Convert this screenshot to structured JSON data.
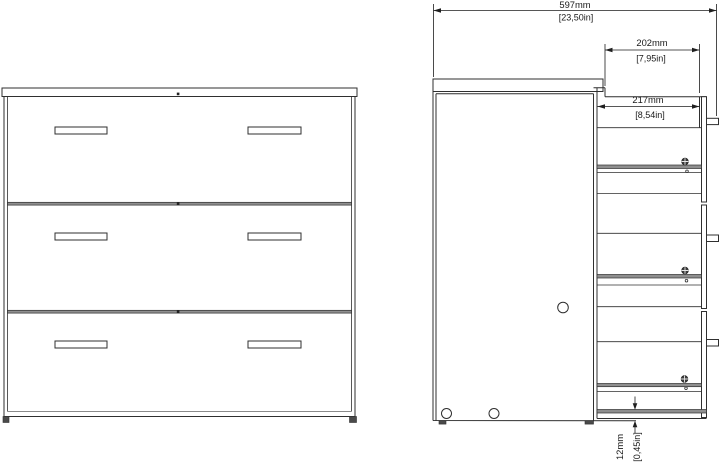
{
  "drawing": {
    "background": "#ffffff",
    "line_color": "#2f2f2f",
    "views": {
      "front_view_name": "front-view-3-drawer-chest",
      "side_view_name": "side-section-view"
    },
    "dimensions": {
      "overall_width": {
        "mm": "597mm",
        "in": "[23,50in]"
      },
      "top_section_depth": {
        "mm": "202mm",
        "in": "[7,95in]"
      },
      "drawer_section_depth": {
        "mm": "217mm",
        "in": "[8,54in]"
      },
      "bottom_clearance": {
        "mm": "12mm",
        "in": "[0,45in]"
      }
    }
  }
}
